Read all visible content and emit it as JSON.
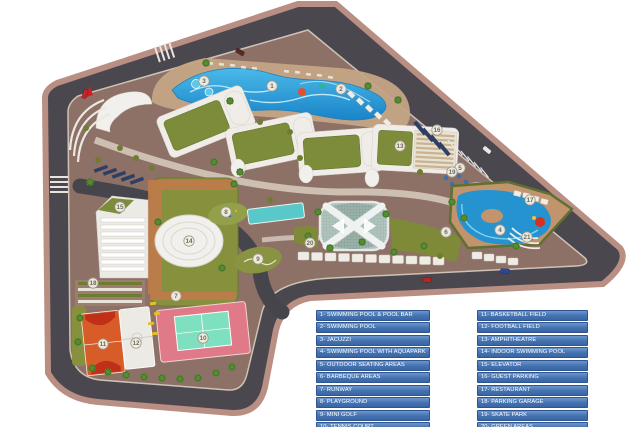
{
  "plan": {
    "colors": {
      "road": "#4a484e",
      "edging": "#b98e83",
      "hardscape": "#8d7066",
      "green_area": "#87913d",
      "pool_blue": "#2593cf",
      "track_orange": "#c07a4a",
      "legend_blue": "#4372b0",
      "marker_fill": "#f2eee2",
      "tennis_pink": "#e07a88",
      "tennis_court_teal": "#7fe0c0",
      "basketball_orange": "#d85c28"
    },
    "legend": {
      "left": [
        "1- SWIMMING POOL & POOL BAR",
        "2- SWIMMING POOL",
        "3- JACUZZI",
        "4- SWIMMING POOL WITH AQUAPARK",
        "5- OUTDOOR SEATING AREAS",
        "6- BARBEQUE AREAS",
        "7- RUNWAY",
        "8- PLAYGROUND",
        "9- MINI GOLF",
        "10- TENNIS COURT"
      ],
      "right": [
        "11- BASKETBALL FIELD",
        "12- FOOTBALL FIELD",
        "13- AMPHITHEATRE",
        "14- INDOOR SWIMMING POOL",
        "15- ELEVATOR",
        "16- GUEST PARKING",
        "17- RESTAURANT",
        "18- PARKING GARAGE",
        "19- SKATE PARK",
        "20- GREEN AREAS",
        "21- OUTDOOR CINEMA"
      ]
    },
    "markers": [
      {
        "n": "1",
        "x": 272,
        "y": 86
      },
      {
        "n": "2",
        "x": 341,
        "y": 89
      },
      {
        "n": "3",
        "x": 204,
        "y": 81
      },
      {
        "n": "4",
        "x": 500,
        "y": 230
      },
      {
        "n": "5",
        "x": 460,
        "y": 168
      },
      {
        "n": "6",
        "x": 446,
        "y": 232
      },
      {
        "n": "7",
        "x": 176,
        "y": 296
      },
      {
        "n": "8",
        "x": 226,
        "y": 212
      },
      {
        "n": "9",
        "x": 258,
        "y": 259
      },
      {
        "n": "10",
        "x": 203,
        "y": 338
      },
      {
        "n": "11",
        "x": 103,
        "y": 344
      },
      {
        "n": "12",
        "x": 136,
        "y": 343
      },
      {
        "n": "13",
        "x": 400,
        "y": 146
      },
      {
        "n": "14",
        "x": 189,
        "y": 241
      },
      {
        "n": "15",
        "x": 120,
        "y": 207
      },
      {
        "n": "16",
        "x": 437,
        "y": 130
      },
      {
        "n": "17",
        "x": 530,
        "y": 200
      },
      {
        "n": "18",
        "x": 93,
        "y": 283
      },
      {
        "n": "19",
        "x": 452,
        "y": 172
      },
      {
        "n": "20",
        "x": 310,
        "y": 243
      },
      {
        "n": "21",
        "x": 527,
        "y": 237
      }
    ],
    "cars": [
      {
        "x": 85,
        "y": 94,
        "r": -70,
        "c": "#c0252a"
      },
      {
        "x": 240,
        "y": 52,
        "r": 32,
        "c": "#5a2828"
      },
      {
        "x": 487,
        "y": 150,
        "r": 40,
        "c": "#e8e8e8"
      },
      {
        "x": 427,
        "y": 280,
        "r": 2,
        "c": "#b02828"
      },
      {
        "x": 505,
        "y": 271,
        "r": 2,
        "c": "#2848a0"
      }
    ],
    "trees": [
      {
        "x": 92,
        "y": 368,
        "t": "palm"
      },
      {
        "x": 108,
        "y": 372,
        "t": "palm"
      },
      {
        "x": 126,
        "y": 375,
        "t": "palm"
      },
      {
        "x": 144,
        "y": 377,
        "t": "palm"
      },
      {
        "x": 162,
        "y": 378,
        "t": "palm"
      },
      {
        "x": 180,
        "y": 379,
        "t": "palm"
      },
      {
        "x": 198,
        "y": 378,
        "t": "palm"
      },
      {
        "x": 216,
        "y": 373,
        "t": "palm"
      },
      {
        "x": 232,
        "y": 367,
        "t": "palm"
      },
      {
        "x": 80,
        "y": 318,
        "t": "palm"
      },
      {
        "x": 78,
        "y": 342,
        "t": "palm"
      },
      {
        "x": 90,
        "y": 182,
        "t": "palm"
      },
      {
        "x": 234,
        "y": 184,
        "t": "palm"
      },
      {
        "x": 214,
        "y": 162,
        "t": "palm"
      },
      {
        "x": 240,
        "y": 172,
        "t": "palm"
      },
      {
        "x": 230,
        "y": 101,
        "t": "palm"
      },
      {
        "x": 206,
        "y": 63,
        "t": "palm"
      },
      {
        "x": 308,
        "y": 236,
        "t": "palm"
      },
      {
        "x": 330,
        "y": 248,
        "t": "palm"
      },
      {
        "x": 362,
        "y": 242,
        "t": "palm"
      },
      {
        "x": 394,
        "y": 252,
        "t": "palm"
      },
      {
        "x": 424,
        "y": 246,
        "t": "palm"
      },
      {
        "x": 158,
        "y": 222,
        "t": "palm"
      },
      {
        "x": 222,
        "y": 268,
        "t": "palm"
      },
      {
        "x": 452,
        "y": 202,
        "t": "palm"
      },
      {
        "x": 464,
        "y": 218,
        "t": "palm"
      },
      {
        "x": 516,
        "y": 246,
        "t": "palm"
      },
      {
        "x": 318,
        "y": 212,
        "t": "palm"
      },
      {
        "x": 386,
        "y": 214,
        "t": "palm"
      },
      {
        "x": 368,
        "y": 86,
        "t": "palm"
      },
      {
        "x": 398,
        "y": 100,
        "t": "palm"
      },
      {
        "x": 120,
        "y": 148,
        "t": "shrub"
      },
      {
        "x": 136,
        "y": 158,
        "t": "shrub"
      },
      {
        "x": 152,
        "y": 168,
        "t": "shrub"
      },
      {
        "x": 98,
        "y": 160,
        "t": "shrub"
      },
      {
        "x": 260,
        "y": 122,
        "t": "shrub"
      },
      {
        "x": 290,
        "y": 132,
        "t": "shrub"
      },
      {
        "x": 420,
        "y": 172,
        "t": "shrub"
      },
      {
        "x": 300,
        "y": 158,
        "t": "shrub"
      },
      {
        "x": 270,
        "y": 200,
        "t": "shrub"
      },
      {
        "x": 440,
        "y": 256,
        "t": "shrub"
      },
      {
        "x": 86,
        "y": 128,
        "t": "shrub"
      }
    ]
  }
}
